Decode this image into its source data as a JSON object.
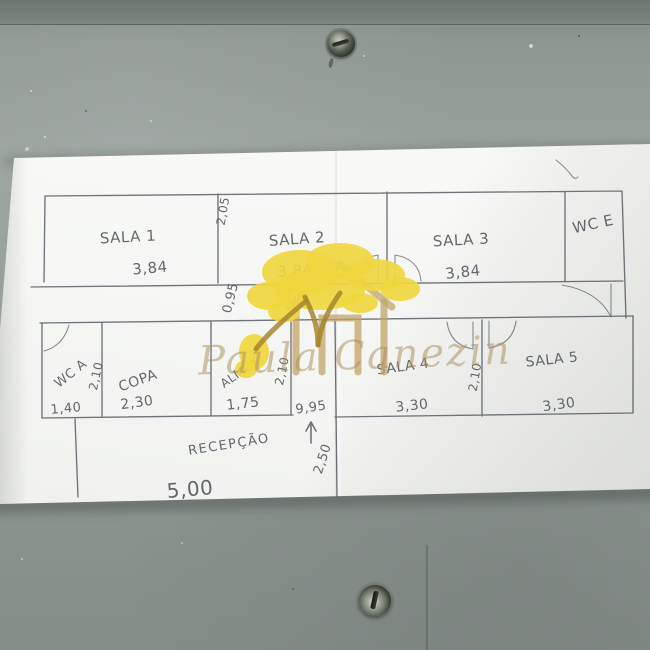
{
  "watermark": {
    "name": "Paula Canezin"
  },
  "plan": {
    "top_row": [
      {
        "label": "SALA 1",
        "width": "3,84"
      },
      {
        "label": "SALA 2",
        "width": "3,84"
      },
      {
        "label": "SALA 3",
        "width": "3,84"
      },
      {
        "label": "WC E"
      }
    ],
    "bottom_row": [
      {
        "label": "WC A",
        "width": "1,40"
      },
      {
        "label": "COPA",
        "width": "2,30"
      },
      {
        "label": "ALMOX",
        "width": "1,75"
      },
      {
        "label": "SALA 4",
        "width": "3,30"
      },
      {
        "label": "SALA 5",
        "width": "3,30"
      }
    ],
    "reception": {
      "label": "RECEPÇÃO",
      "width": "5,00"
    },
    "measurements": {
      "top_room_depth": "2,05",
      "corridor_width": "0,95",
      "depths": [
        "2,10",
        "2,10",
        "2,10"
      ],
      "entrance_width": "9,95",
      "entrance_depth": "2,50"
    }
  }
}
